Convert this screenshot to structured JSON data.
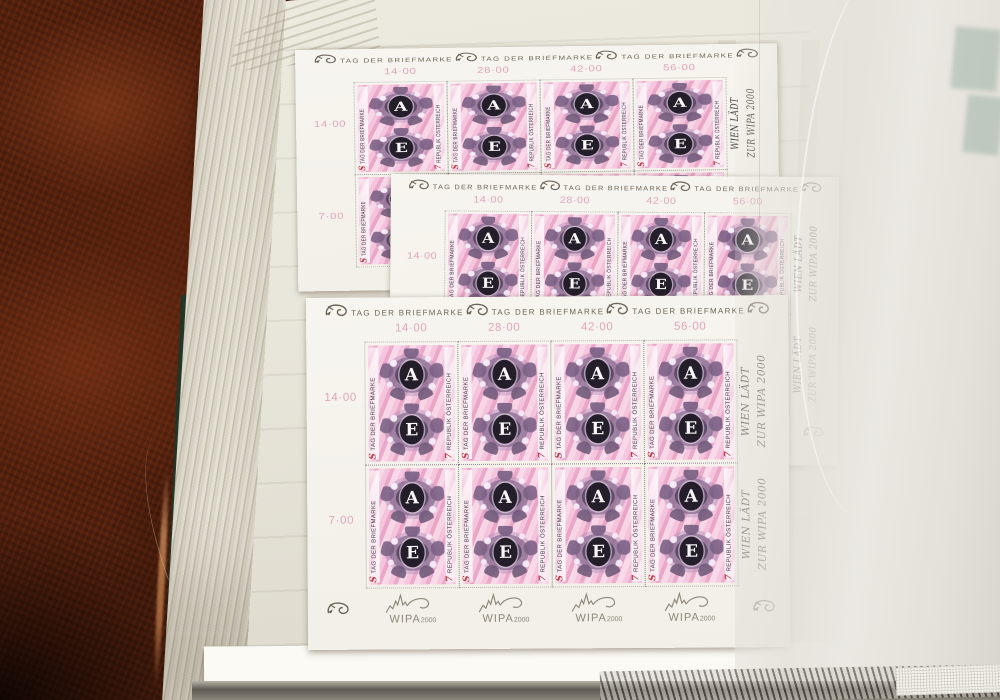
{
  "sheet": {
    "header_label": "TAG DER BRIEFMARKE",
    "header_icon": "posthorn-icon",
    "column_totals": [
      "14·00",
      "28·00",
      "42·00",
      "56·00"
    ],
    "row_totals": [
      "14·00",
      "7·00"
    ],
    "right_margin": {
      "line1": "WIEN LÄDT",
      "line2": "ZUR WIPA 2000"
    },
    "stamp": {
      "top_letter": "A",
      "bottom_letter": "E",
      "currency_symbol": "S",
      "left_vertical_text": "TAG DER BRIEFMARKE",
      "denomination": "7",
      "right_vertical_text": "REPUBLIK ÖSTERREICH"
    },
    "bottom_margin": {
      "logo_text": "WIPA",
      "logo_year": "2000",
      "logo_icon": "wipa-2000-skyline-icon"
    }
  },
  "colors": {
    "carpet": "#53200d",
    "album_page": "#e9e6db",
    "album_cover_green": "#2c3f31",
    "sheet_paper": "#f4f2ec",
    "stamp_pink": "#eeb0cd",
    "ornament_purple": "#6a5372",
    "oval_black": "#241e2a",
    "accent_red": "#c23848",
    "margin_pink": "#e2a4bc",
    "print_gray": "#6e6559",
    "logo_gray": "#8f877a"
  }
}
